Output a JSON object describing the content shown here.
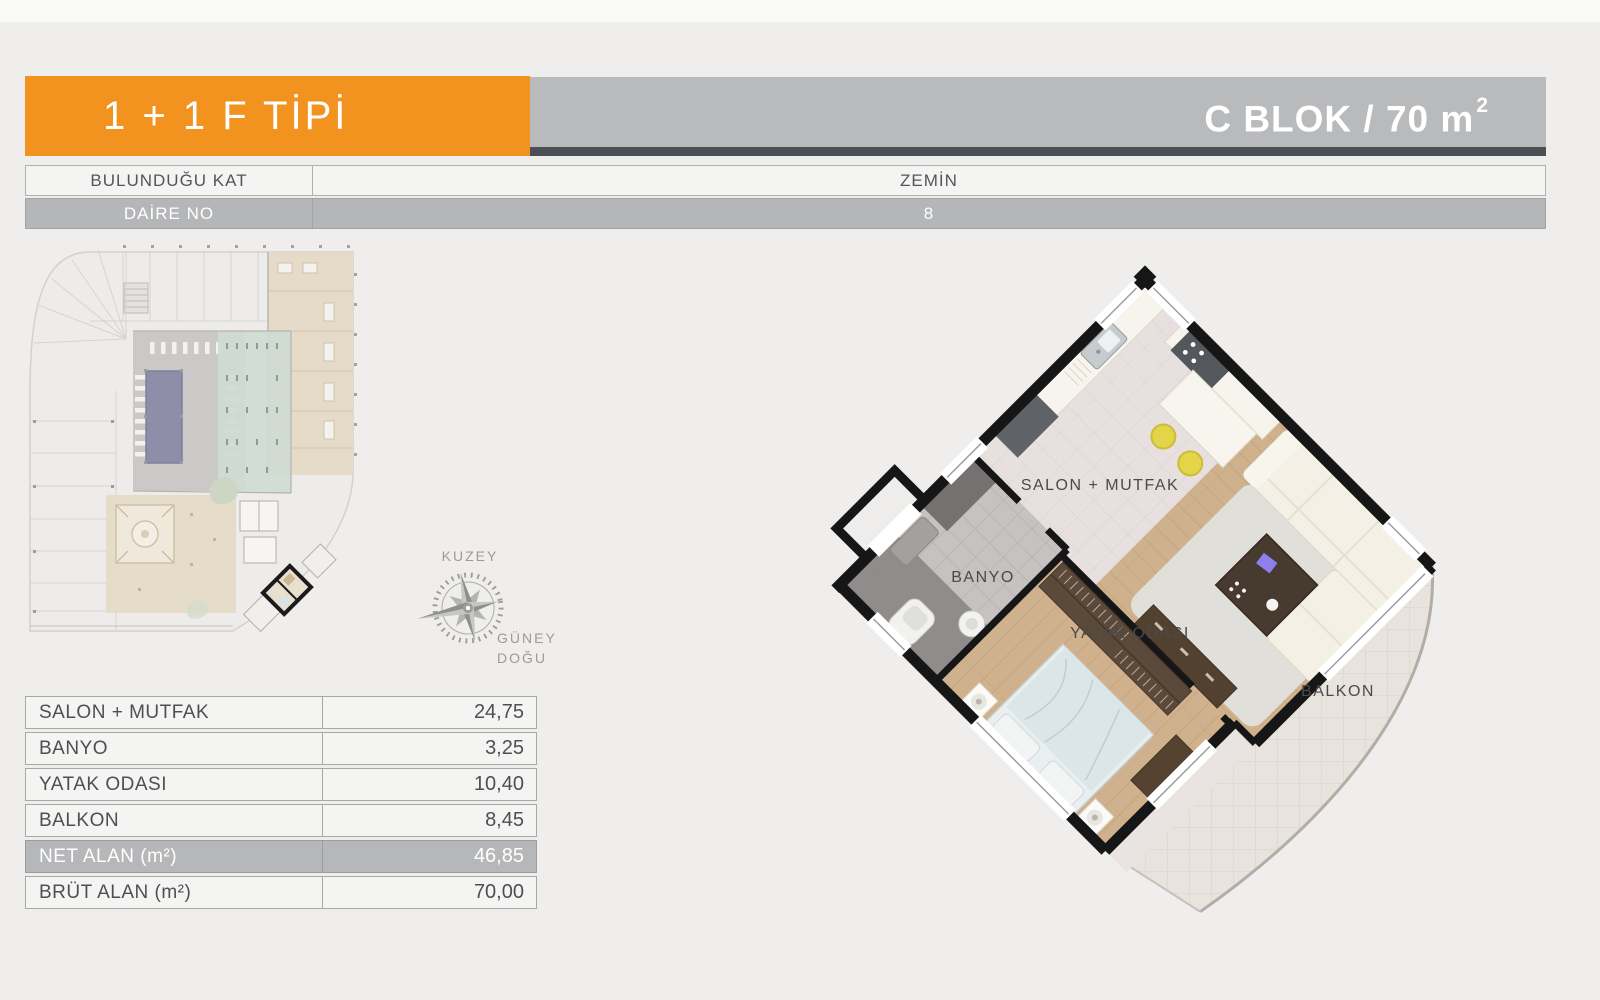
{
  "header": {
    "type_label": "1 + 1 F TİPİ",
    "block_label": "C BLOK / 70 m",
    "block_sup": "2",
    "accent_color": "#f2921f"
  },
  "info_table": {
    "rows": [
      {
        "label": "BULUNDUĞU KAT",
        "value": "ZEMİN"
      },
      {
        "label": "DAİRE NO",
        "value": "8"
      }
    ]
  },
  "area_table": {
    "rows": [
      {
        "label": "SALON + MUTFAK",
        "value": "24,75"
      },
      {
        "label": "BANYO",
        "value": "3,25"
      },
      {
        "label": "YATAK ODASI",
        "value": "10,40"
      },
      {
        "label": "BALKON",
        "value": "8,45"
      },
      {
        "label": "NET ALAN (m²)",
        "value": "46,85"
      },
      {
        "label": "BRÜT ALAN (m²)",
        "value": "70,00"
      }
    ]
  },
  "compass": {
    "north": "KUZEY",
    "south_line1": "GÜNEY",
    "south_line2": "DOĞU"
  },
  "floor_plan": {
    "salon_label": "SALON + MUTFAK",
    "banyo_label": "BANYO",
    "yatak_label": "YATAK ODASI",
    "balkon_label": "BALKON"
  },
  "colors": {
    "accent_orange": "#f2921f",
    "header_gray": "#b9babc",
    "dark_strip": "#4c4f53",
    "row_gray": "#b5b6b8",
    "wood_floor": "#cfb28d",
    "pool_blue": "#8f8ea8",
    "stool_yellow": "#e3d44a"
  }
}
